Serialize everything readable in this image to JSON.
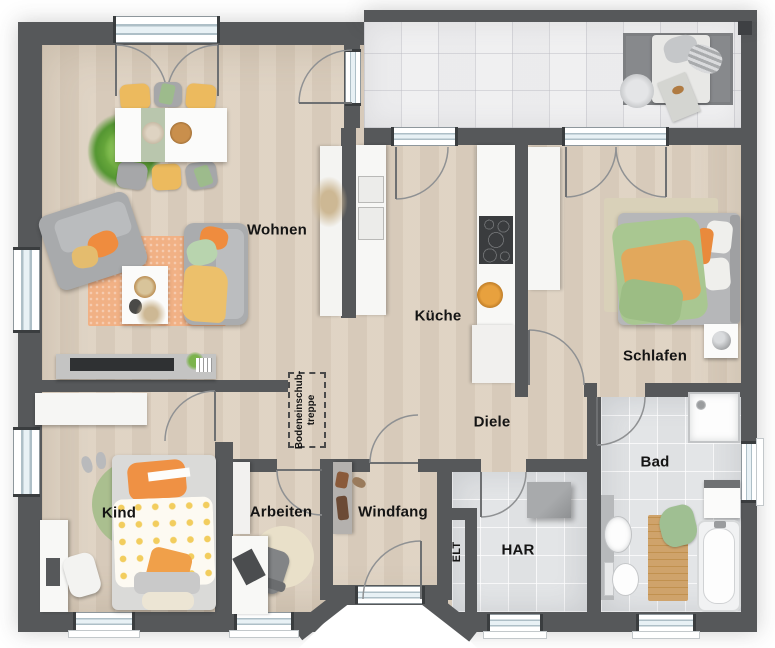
{
  "rooms": {
    "wohnen": {
      "label": "Wohnen"
    },
    "kueche": {
      "label": "Küche"
    },
    "schlafen": {
      "label": "Schlafen"
    },
    "diele": {
      "label": "Diele"
    },
    "bad": {
      "label": "Bad"
    },
    "kind": {
      "label": "Kind"
    },
    "arbeiten": {
      "label": "Arbeiten"
    },
    "windfang": {
      "label": "Windfang"
    },
    "har": {
      "label": "HAR"
    },
    "elt": {
      "label": "ELT"
    }
  },
  "annotations": {
    "attic_stairs": {
      "line1": "Bodeneinschub-",
      "line2": "treppe"
    }
  },
  "colors": {
    "wall": "#56585a",
    "wood_floor": "#dccfbe",
    "terrace_tile": "#f0f0f1",
    "bath_tile": "#e3e5e7",
    "rug_orange": "#f1b185",
    "rug_green": "#aabf8f",
    "rug_beige": "#e9e0c9",
    "accent_orange": "#ef8c3e",
    "accent_green": "#b8d4ae",
    "accent_yellow": "#ecba5e",
    "sofa_gray": "#a8aaac",
    "bed_green": "#a9c791",
    "bed_orange": "#e2a85c",
    "label_text": "#141414"
  }
}
